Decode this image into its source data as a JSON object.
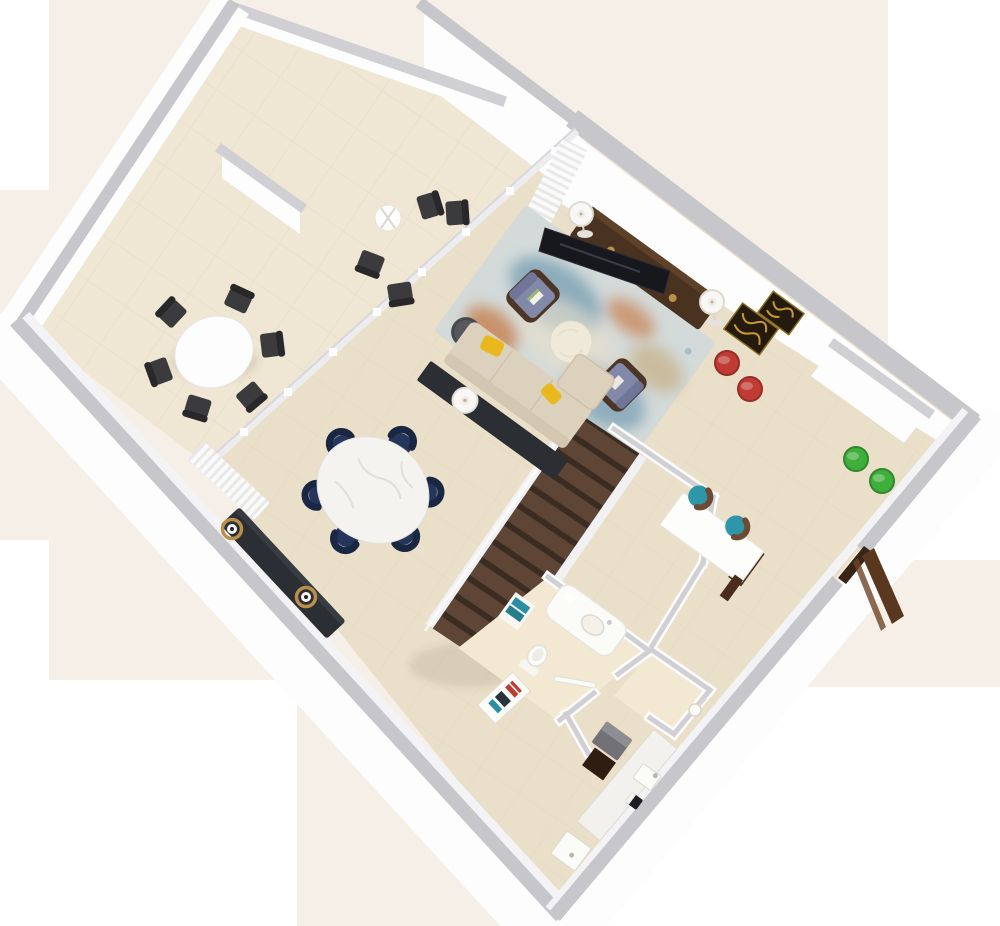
{
  "image": {
    "kind": "3d-floor-plan-render",
    "view": "rotated isometric top-down",
    "subject": "hotel-suite upper level floor plan"
  },
  "palette": {
    "background": "#f6efe7",
    "patchWhite": "#ffffff",
    "terraceFloor": "#efe6d3",
    "interiorFloor": "#eadfc8",
    "bathFloor": "#f3e9d2",
    "tileLine": "#ddd1b9",
    "wallCap": "#c6c6cb",
    "wallCapSoft": "#cfcfd4",
    "wallFace": "#fdfdfd",
    "wallFaceShade": "#f3f3f5",
    "windowFrame": "#ededf0",
    "curtainLight": "#fbfbfb",
    "curtainShade": "#e8e8ea",
    "chairDark": "#3b3b3e",
    "chairDarkBack": "#28282b",
    "navy": "#25355c",
    "navyBack": "#1a2742",
    "marble": "#f4f3f0",
    "marbleVein": "#d9d9d5",
    "sofa": "#dcd1bd",
    "sofaShade": "#cec2ab",
    "pillowYellow": "#e9b81f",
    "consoleBlack": "#2b2e33",
    "sideTableGray": "#57585d",
    "armFrame": "#4d3526",
    "armCushion": "#8289a8",
    "rugBase": "#d2dad9",
    "rugTeal": "#7fa3b6",
    "rugOrange": "#c77e4d",
    "rugTan": "#c8b694",
    "rugCream": "#e6decd",
    "coffeeTable": "#efe9da",
    "tvWood": "#4a3221",
    "tvScreen": "#17181d",
    "brass": "#b98f4a",
    "lampWhite": "#f8f7f3",
    "lampRim": "#dedad0",
    "artGold": "#c79a36",
    "artDark": "#241b0e",
    "stoolRed": "#c03b33",
    "stoolGreen": "#3fae3a",
    "stairTread": "#5e4536",
    "stairRiser": "#3b2c22",
    "stairStringer": "#f1f1f3",
    "deskWhite": "#fdfdfb",
    "deskWood": "#4a2d1b",
    "chairTeal": "#2f95a8",
    "chairTealBack": "#6d4a33",
    "towelTeal": "#2b8fa4",
    "towelTealDark": "#247e90",
    "doorBrown": "#5a381f",
    "doorOpening": "#3a2415",
    "fixtureWhite": "#fbfbf8",
    "fixtureStroke": "#ddd9cf",
    "applianceGray": "#717176",
    "applianceTop": "#8d8d92",
    "cabinetDark": "#2f1d12",
    "shadow": "rgba(90,70,50,0.12)"
  },
  "rooms": [
    {
      "id": "terrace",
      "furniture": [
        "outdoor-round-table",
        "outdoor-chair x6",
        "bistro-table",
        "bistro-chair x2",
        "lounge-chair x2"
      ]
    },
    {
      "id": "living-room",
      "furniture": [
        "sofa-with-chaise",
        "yellow-pillow x2",
        "black-console-table",
        "drum-table-lamp",
        "gray-side-table",
        "armchair x2",
        "round-coffee-table",
        "abstract-area-rug",
        "tv-console",
        "television",
        "floor-lamp x2",
        "gold-wall-art x2",
        "red-stool x2"
      ]
    },
    {
      "id": "dining-area",
      "furniture": [
        "marble-round-table",
        "navy-dining-chair x6",
        "dark-sideboard",
        "ring-lamp x2"
      ]
    },
    {
      "id": "den-office",
      "furniture": [
        "white-desk",
        "teal-desk-chair x2",
        "green-stool x2"
      ]
    },
    {
      "id": "staircase",
      "furniture": [
        "wood-stairs",
        "white-stringer x2"
      ]
    },
    {
      "id": "bathroom",
      "furniture": [
        "vanity-sink",
        "toilet",
        "towel-shelf",
        "door"
      ]
    },
    {
      "id": "shower-room",
      "furniture": [
        "shower-head"
      ]
    },
    {
      "id": "kitchenette",
      "furniture": [
        "counter",
        "gray-appliance",
        "dark-cabinet",
        "sink",
        "coffee-maker",
        "shower-tray",
        "minibar-shelf"
      ]
    }
  ]
}
